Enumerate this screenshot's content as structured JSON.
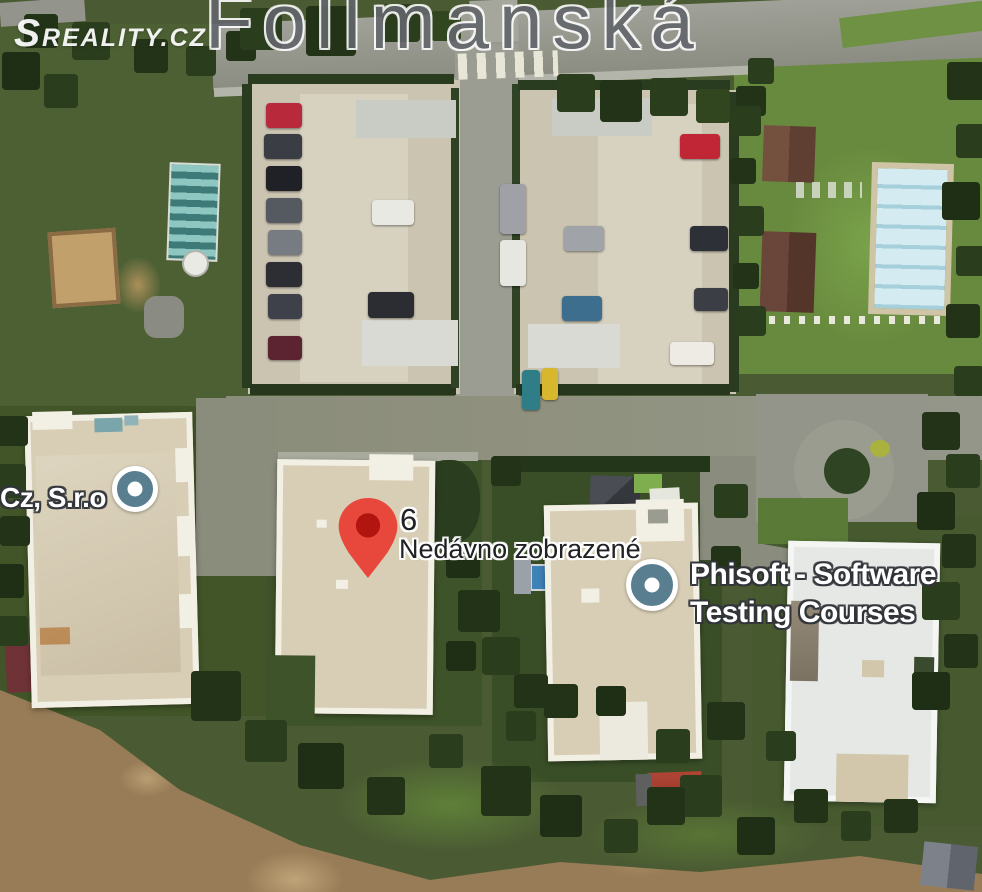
{
  "watermark": {
    "logo_text": "Sreality.cz"
  },
  "map": {
    "street_label": "Follmanská",
    "markers": [
      {
        "id": "recently-viewed-pin",
        "type": "red-pin",
        "number_label": "6",
        "label": "Nedávno zobrazené"
      },
      {
        "id": "cz-sro",
        "type": "place-circle",
        "label": "Cz, S.r.o"
      },
      {
        "id": "phisoft",
        "type": "place-circle",
        "label_line1": "Phisoft - Software",
        "label_line2": "Testing Courses"
      }
    ]
  },
  "colors": {
    "pin-red": "#e8483b",
    "pin-red-dark": "#b21510",
    "place-marker-fill": "#587e90",
    "label-white": "#ffffff",
    "label-dark": "#202124",
    "street-gray": "#63666b"
  }
}
